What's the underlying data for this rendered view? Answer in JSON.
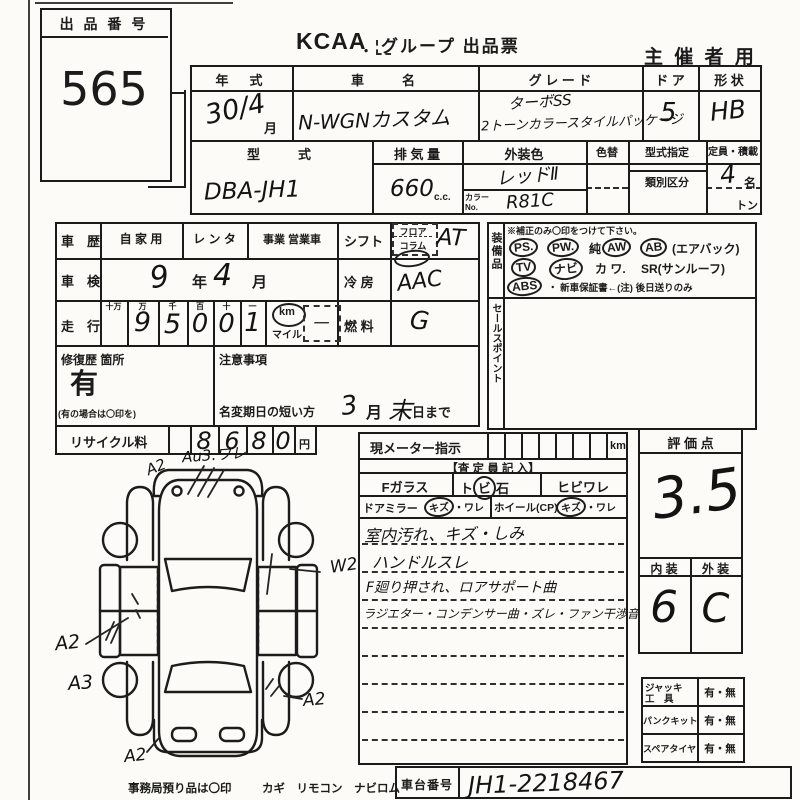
{
  "lot": {
    "label": "出 品 番 号",
    "number": "565"
  },
  "header": {
    "brand": "KCAA",
    "title": "．グループ 出品票",
    "organizer": "主 催 者 用"
  },
  "spec": {
    "year_label": "年　式",
    "year_value": "30/4",
    "year_unit": "月",
    "name_label": "車　　名",
    "name_value": "N-WGNカスタム",
    "grade_label": "グ レ ー ド",
    "grade_line1": "ターボSS",
    "grade_line2": "2トーンカラースタイルパッケージ",
    "door_label": "ド ア",
    "door_value": "5",
    "shape_label": "形 状",
    "shape_value": "HB",
    "model_label": "型　　式",
    "model_value": "DBA-JH1",
    "disp_label": "排 気 量",
    "disp_value": "660",
    "disp_unit": "c.c.",
    "color_label": "外装色",
    "color_value": "レッドⅡ",
    "color_no_label": "カラーNo.",
    "color_no_value": "R81C",
    "color_change_label": "色替",
    "type_desig_label": "型式指定",
    "class_label": "類別区分",
    "capacity_label": "定員・積載",
    "capacity_value": "4",
    "capacity_unit": "名",
    "load_unit": "トン"
  },
  "history": {
    "career_label": "車　歴",
    "career_opt1": "自 家 用",
    "career_opt2": "レ ン タ",
    "career_opt3": "事業 営業車",
    "inspection_label": "車　検",
    "inspection_year": "9",
    "year_unit": "年",
    "inspection_month": "4",
    "month_unit": "月",
    "mileage_label": "走　行",
    "digit_headers": [
      "十万",
      "万",
      "千",
      "百",
      "十",
      "一"
    ],
    "digits": [
      "",
      "9",
      "5",
      "0",
      "0",
      "1"
    ],
    "unit_km": "km",
    "unit_mile": "マイル",
    "mile_mark": "一",
    "repair_label": "修復歴 箇所",
    "repair_value": "有",
    "repair_note": "(有の場合は〇印を)",
    "caution_label": "注意事項",
    "rename_label": "名変期日の短い方",
    "rename_month": "3",
    "rename_month_unit": "月",
    "rename_day": "末",
    "rename_day_unit": "日まで",
    "recycle_label": "リサイクル料",
    "recycle_digits": [
      "8",
      "6",
      "8",
      "0"
    ],
    "recycle_unit": "円"
  },
  "drivetrain": {
    "shift_label": "シフト",
    "shift_opt1": "フロア",
    "shift_opt2": "コラム",
    "shift_value": "AT",
    "ac_label": "冷 房",
    "ac_value": "AAC",
    "fuel_label": "燃 料",
    "fuel_value": "G"
  },
  "equipment": {
    "label": "装備品",
    "note": "※補正のみ〇印をつけて下さい。",
    "row1": [
      {
        "t": "PS.",
        "c": true
      },
      {
        "t": "PW.",
        "c": true
      },
      {
        "t": "純",
        "c": false
      },
      {
        "t": "AW",
        "c": true
      },
      {
        "t": "AB",
        "c": true
      },
      {
        "t": "(エアバック)",
        "c": false
      }
    ],
    "row2": [
      {
        "t": "TV",
        "c": true
      },
      {
        "t": "ナビ",
        "c": true
      },
      {
        "t": "カ ワ.",
        "c": false
      },
      {
        "t": "SR(サンルーフ)",
        "c": false
      }
    ],
    "row3": [
      {
        "t": "ABS",
        "c": true
      },
      {
        "t": "・ 新車保証書←(注) 後日送りのみ",
        "c": false
      }
    ]
  },
  "sales": {
    "label": "セールスポイント"
  },
  "meter": {
    "label": "現メーター指示",
    "unit": "km"
  },
  "inspector": {
    "title": "【査 定 員 記 入】",
    "f_glass": "Fガラス",
    "stone_l": "ト",
    "stone_c": "ビ",
    "stone_r": "石",
    "crack": "ヒビワレ",
    "door_mirror": "ドアミラー",
    "mirror_kizu": "キズ",
    "mirror_ware": "・ワレ",
    "wheel": "ホイール(CP)",
    "wheel_kizu": "キズ",
    "wheel_ware": "・ワレ",
    "notes": [
      "室内汚れ、キズ・しみ",
      "ハンドルスレ",
      "F廻り押され、ロアサポート曲",
      "ラジエター・コンデンサー曲・ズレ・ファン干渉音"
    ]
  },
  "evaluation": {
    "label": "評 価 点",
    "score": "3.5",
    "interior_label": "内 装",
    "exterior_label": "外 装",
    "interior_value": "6",
    "exterior_value": "C"
  },
  "tools": [
    {
      "l1": "ジャッキ",
      "l2": "工　具",
      "value": "有・無"
    },
    {
      "l1": "パンクキット",
      "l2": "",
      "value": "有・無"
    },
    {
      "l1": "スペアタイヤ",
      "l2": "",
      "value": "有・無"
    }
  ],
  "chassis": {
    "label": "車台番号",
    "value": "JH1-2218467"
  },
  "footer": {
    "note": "事務局預り品は〇印",
    "items": "カギ　リモコン　ナビロム"
  },
  "diagram": {
    "marks": {
      "front_left": "A2",
      "front_top": "Au3.ワレ",
      "right_side": "W2",
      "left_side": "A2",
      "left_lower": "A3",
      "rear_right": "A2",
      "rear_bottom": "A2"
    }
  }
}
